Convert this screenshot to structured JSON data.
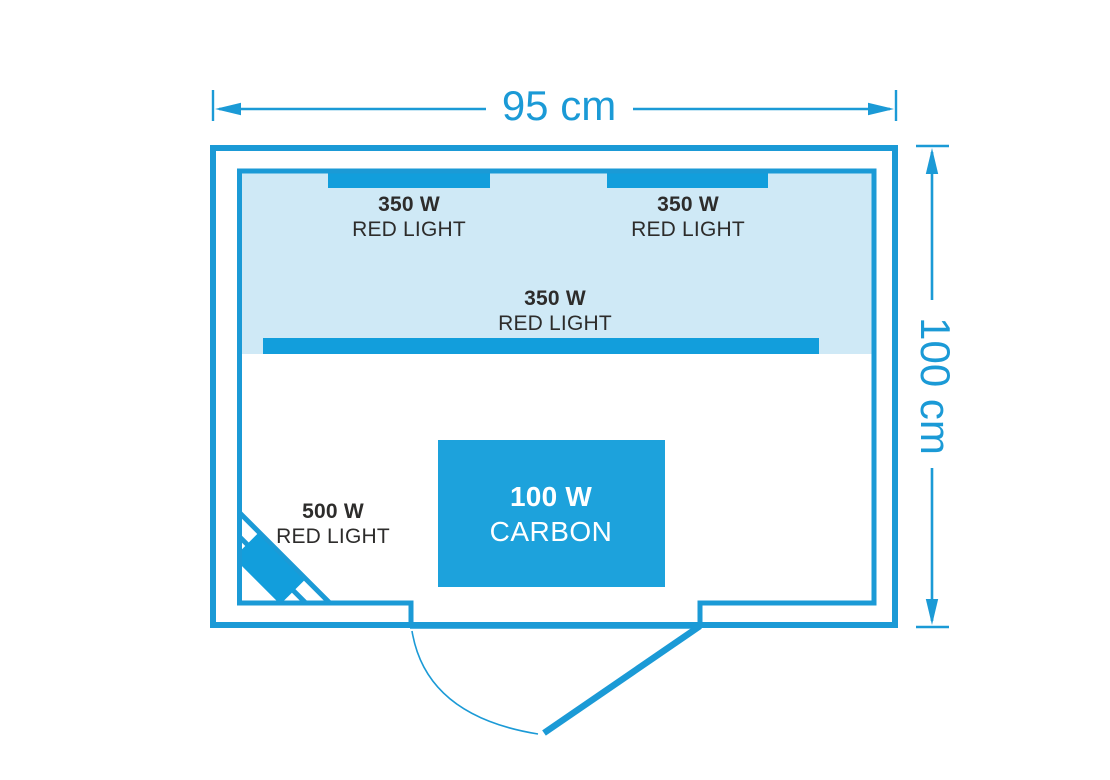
{
  "diagram": {
    "title": "sauna infrared heater floor plan",
    "colors": {
      "accent_blue": "#1b9ad6",
      "heater_fill": "#129edc",
      "heated_zone_fill": "#cfe9f6",
      "label_text": "#2d2c2b",
      "carbon_text": "#ffffff"
    },
    "dimensions": {
      "width": "95 cm",
      "height": "100 cm"
    },
    "heaters": {
      "top_left": {
        "power": "350 W",
        "type": "RED LIGHT"
      },
      "top_right": {
        "power": "350 W",
        "type": "RED LIGHT"
      },
      "middle": {
        "power": "350 W",
        "type": "RED LIGHT"
      },
      "corner": {
        "power": "500 W",
        "type": "RED LIGHT"
      },
      "carbon": {
        "power": "100 W",
        "type": "CARBON"
      }
    }
  }
}
